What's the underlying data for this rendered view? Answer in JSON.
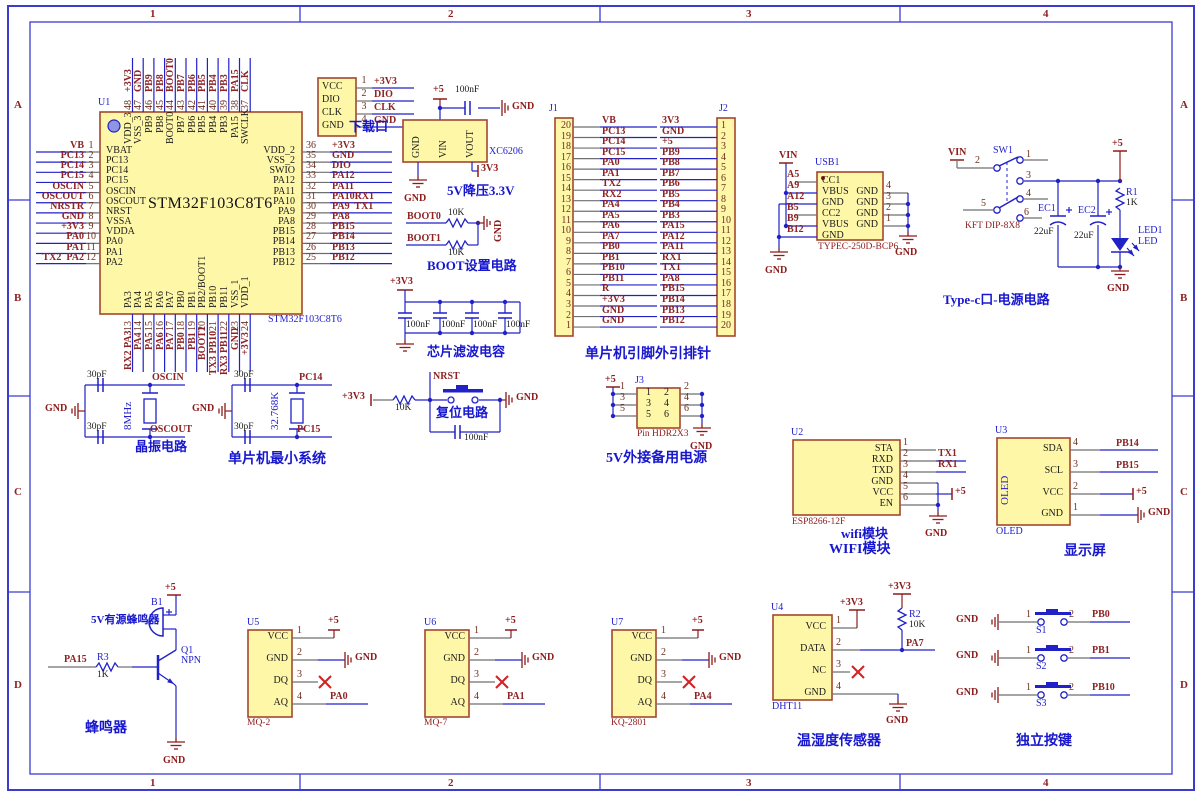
{
  "sheet": {
    "h_zones": [
      "1",
      "2",
      "3",
      "4"
    ],
    "v_zones": [
      "A",
      "B",
      "C",
      "D"
    ]
  },
  "colors": {
    "component_fill": "#fef7a8",
    "component_border": "#a3462e",
    "wire": "#2121c8",
    "power": "#8d1a1a",
    "net_text": "#8d2323",
    "designator": "#2020cc",
    "frame": "#3b3bd2"
  },
  "mcu": {
    "designator": "U1",
    "title": "STM32F103C8T6",
    "sub_label": "STM32F103C8T6",
    "left_pins": [
      {
        "net": "VB",
        "num": "1",
        "name": "VBAT"
      },
      {
        "net": "PC13",
        "num": "2",
        "name": "PC13"
      },
      {
        "net": "PC14",
        "num": "3",
        "name": "PC14"
      },
      {
        "net": "PC15",
        "num": "4",
        "name": "PC15"
      },
      {
        "net": "OSCIN",
        "num": "5",
        "name": "OSCIN"
      },
      {
        "net": "OSCOUT",
        "num": "6",
        "name": "OSCOUT"
      },
      {
        "net": "NRSTR",
        "num": "7",
        "name": "NRST"
      },
      {
        "net": "GND",
        "num": "8",
        "name": "VSSA"
      },
      {
        "net": "+3V3",
        "num": "9",
        "name": "VDDA"
      },
      {
        "net": "PA0",
        "num": "10",
        "name": "PA0"
      },
      {
        "net": "PA1",
        "num": "11",
        "name": "PA1"
      },
      {
        "net": "TX2  PA2",
        "num": "12",
        "name": "PA2"
      }
    ],
    "right_pins": [
      {
        "num": "36",
        "net": "+3V3",
        "name": "VDD_2"
      },
      {
        "num": "35",
        "net": "GND",
        "name": "VSS_2"
      },
      {
        "num": "34",
        "net": "DIO",
        "name": "SWIO"
      },
      {
        "num": "33",
        "net": "PA12",
        "name": "PA12"
      },
      {
        "num": "32",
        "net": "PA11",
        "name": "PA11"
      },
      {
        "num": "31",
        "net": "PA10RX1",
        "name": "PA10"
      },
      {
        "num": "30",
        "net": "PA9  TX1",
        "name": "PA9"
      },
      {
        "num": "29",
        "net": "PA8",
        "name": "PA8"
      },
      {
        "num": "28",
        "net": "PB15",
        "name": "PB15"
      },
      {
        "num": "27",
        "net": "PB14",
        "name": "PB14"
      },
      {
        "num": "26",
        "net": "PB13",
        "name": "PB13"
      },
      {
        "num": "25",
        "net": "PB12",
        "name": "PB12"
      }
    ],
    "top_pins": [
      {
        "num": "48",
        "net": "+3V3",
        "name": "VDD_3"
      },
      {
        "num": "47",
        "net": "GND",
        "name": "VSS_3"
      },
      {
        "num": "46",
        "net": "PB9",
        "name": "PB9"
      },
      {
        "num": "45",
        "net": "PB8",
        "name": "PB8"
      },
      {
        "num": "44",
        "net": "BOOT0",
        "name": "BOOT0"
      },
      {
        "num": "43",
        "net": "PB7",
        "name": "PB7"
      },
      {
        "num": "42",
        "net": "PB6",
        "name": "PB6"
      },
      {
        "num": "41",
        "net": "PB5",
        "name": "PB5"
      },
      {
        "num": "40",
        "net": "PB4",
        "name": "PB4"
      },
      {
        "num": "39",
        "net": "PB3",
        "name": "PB3"
      },
      {
        "num": "38",
        "net": "PA15",
        "name": "PA15"
      },
      {
        "num": "37",
        "net": "CLK",
        "name": "SWCLK"
      }
    ],
    "bottom_pins": [
      {
        "num": "13",
        "net": "RX2 PA3",
        "name": "PA3"
      },
      {
        "num": "14",
        "net": "PA4",
        "name": "PA4"
      },
      {
        "num": "15",
        "net": "PA5",
        "name": "PA5"
      },
      {
        "num": "16",
        "net": "PA6",
        "name": "PA6"
      },
      {
        "num": "17",
        "net": "PA7",
        "name": "PA7"
      },
      {
        "num": "18",
        "net": "PB0",
        "name": "PB0"
      },
      {
        "num": "19",
        "net": "PB1",
        "name": "PB1"
      },
      {
        "num": "20",
        "net": "BOOT1",
        "name": "PB2/BOOT1"
      },
      {
        "num": "21",
        "net": "TX3 PB10",
        "name": "PB10"
      },
      {
        "num": "22",
        "net": "RX3 PB11",
        "name": "PB11"
      },
      {
        "num": "23",
        "net": "GND",
        "name": "VSS_1"
      },
      {
        "num": "24",
        "net": "+3V3",
        "name": "VDD_1"
      }
    ]
  },
  "download": {
    "caption": "下载口",
    "rows": [
      {
        "name": "VCC",
        "num": "1",
        "net": "+3V3"
      },
      {
        "name": "DIO",
        "num": "2",
        "net": "DIO"
      },
      {
        "name": "CLK",
        "num": "3",
        "net": "CLK"
      },
      {
        "name": "GND",
        "num": "4",
        "net": "GND"
      }
    ]
  },
  "regulator": {
    "plus5": "+5",
    "cap_val": "100nF",
    "gnd_top": "GND",
    "pins": [
      "GND",
      "VIN",
      "VOUT"
    ],
    "part": "XC6206",
    "out_net": "3V3",
    "gnd_bottom": "GND",
    "caption": "5V降压3.3V"
  },
  "boot": {
    "rows": [
      {
        "net": "BOOT0",
        "val": "10K"
      },
      {
        "net": "BOOT1",
        "val": "10K"
      }
    ],
    "gnd": "GND",
    "caption": "BOOT设置电路"
  },
  "filter": {
    "rail": "+3V3",
    "caps": [
      "100nF",
      "100nF",
      "100nF",
      "100nF"
    ],
    "caption": "芯片滤波电容"
  },
  "j1": {
    "designator": "J1",
    "pins": [
      {
        "num": "20",
        "net": "VB"
      },
      {
        "num": "19",
        "net": "PC13"
      },
      {
        "num": "18",
        "net": "PC14"
      },
      {
        "num": "17",
        "net": "PC15"
      },
      {
        "num": "16",
        "net": "PA0"
      },
      {
        "num": "15",
        "net": "PA1"
      },
      {
        "num": "14",
        "net": "TX2"
      },
      {
        "num": "13",
        "net": "RX2"
      },
      {
        "num": "12",
        "net": "PA4"
      },
      {
        "num": "11",
        "net": "PA5"
      },
      {
        "num": "10",
        "net": "PA6"
      },
      {
        "num": "9",
        "net": "PA7"
      },
      {
        "num": "8",
        "net": "PB0"
      },
      {
        "num": "7",
        "net": "PB1"
      },
      {
        "num": "6",
        "net": "PB10"
      },
      {
        "num": "5",
        "net": "PB11"
      },
      {
        "num": "4",
        "net": "R"
      },
      {
        "num": "3",
        "net": "+3V3"
      },
      {
        "num": "2",
        "net": "GND"
      },
      {
        "num": "1",
        "net": "GND"
      }
    ]
  },
  "j2": {
    "designator": "J2",
    "pins": [
      {
        "num": "1",
        "net": "3V3"
      },
      {
        "num": "2",
        "net": "GND"
      },
      {
        "num": "3",
        "net": "+5"
      },
      {
        "num": "4",
        "net": "PB9"
      },
      {
        "num": "5",
        "net": "PB8"
      },
      {
        "num": "6",
        "net": "PB7"
      },
      {
        "num": "7",
        "net": "PB6"
      },
      {
        "num": "8",
        "net": "PB5"
      },
      {
        "num": "9",
        "net": "PB4"
      },
      {
        "num": "10",
        "net": "PB3"
      },
      {
        "num": "11",
        "net": "PA15"
      },
      {
        "num": "12",
        "net": "PA12"
      },
      {
        "num": "13",
        "net": "PA11"
      },
      {
        "num": "14",
        "net": "RX1"
      },
      {
        "num": "15",
        "net": "TX1"
      },
      {
        "num": "16",
        "net": "PA8"
      },
      {
        "num": "17",
        "net": "PB15"
      },
      {
        "num": "18",
        "net": "PB14"
      },
      {
        "num": "19",
        "net": "PB13"
      },
      {
        "num": "20",
        "net": "PB12"
      }
    ]
  },
  "headers_caption": "单片机引脚外引排针",
  "usb": {
    "designator": "USB1",
    "part": "TYPEC-250D-BCP6",
    "vin": "VIN",
    "gnd_left": "GND",
    "gnd_right": "GND",
    "left_pins": [
      {
        "pad": "A5",
        "name": "CC1"
      },
      {
        "pad": "A9",
        "name": "VBUS"
      },
      {
        "pad": "A12",
        "name": "GND"
      },
      {
        "pad": "B5",
        "name": "CC2"
      },
      {
        "pad": "B9",
        "name": "VBUS"
      },
      {
        "pad": "B12",
        "name": "GND"
      }
    ],
    "right_pins": [
      {
        "num": "4",
        "name": "GND"
      },
      {
        "num": "3",
        "name": "GND"
      },
      {
        "num": "2",
        "name": "GND"
      },
      {
        "num": "1",
        "name": "GND"
      }
    ]
  },
  "powersw": {
    "designator": "SW1",
    "part": "KFT DIP-8X8",
    "vin": "VIN",
    "plus5": "+5",
    "pin_nums": [
      "1",
      "2",
      "3",
      "4",
      "5",
      "6"
    ],
    "ec1": {
      "ref": "EC1",
      "val": "22uF"
    },
    "ec2": {
      "ref": "EC2",
      "val": "22uF"
    },
    "r1": {
      "ref": "R1",
      "val": "1K"
    },
    "led": {
      "ref": "LED1",
      "name": "LED"
    },
    "gnd": "GND",
    "caption": "Type-c口-电源电路"
  },
  "xtal1": {
    "cap_top": "30pF",
    "cap_bot": "30pF",
    "freq": "8MHz",
    "net_top": "OSCIN",
    "net_bot": "OSCOUT",
    "gnd": "GND",
    "caption": "晶振电路"
  },
  "xtal2": {
    "cap_top": "30pF",
    "cap_bot": "30pF",
    "freq": "32.768K",
    "net_top": "PC14",
    "net_bot": "PC15",
    "gnd": "GND",
    "caption": "单片机最小系统"
  },
  "reset": {
    "rail": "+3V3",
    "r_val": "10K",
    "net": "NRST",
    "cap_val": "100nF",
    "gnd": "GND",
    "caption": "复位电路"
  },
  "j3": {
    "designator": "J3",
    "plus5": "+5",
    "left_nums": [
      "1",
      "3",
      "5"
    ],
    "right_nums": [
      "2",
      "4",
      "6"
    ],
    "inner_left": [
      "1",
      "3",
      "5"
    ],
    "inner_right": [
      "2",
      "4",
      "6"
    ],
    "part": "Pin HDR2X3",
    "gnd": "GND",
    "caption": "5V外接备用电源"
  },
  "wifi": {
    "designator": "U2",
    "part": "ESP8266-12F",
    "gnd": "GND",
    "plus5": "+5",
    "pins": [
      {
        "name": "STA",
        "num": "1",
        "net": ""
      },
      {
        "name": "RXD",
        "num": "2",
        "net": "TX1"
      },
      {
        "name": "TXD",
        "num": "3",
        "net": "RX1"
      },
      {
        "name": "GND",
        "num": "4",
        "net": ""
      },
      {
        "name": "VCC",
        "num": "5",
        "net": "+5"
      },
      {
        "name": "EN",
        "num": "6",
        "net": ""
      }
    ],
    "caption1": "wifi模块",
    "caption2": "WIFI模块"
  },
  "oled": {
    "designator": "U3",
    "body": "OLED",
    "part": "OLED",
    "gnd": "GND",
    "plus5": "+5",
    "pins": [
      {
        "name": "SDA",
        "num": "4",
        "net": "PB14"
      },
      {
        "name": "SCL",
        "num": "3",
        "net": "PB15"
      },
      {
        "name": "VCC",
        "num": "2",
        "net": "+5"
      },
      {
        "name": "GND",
        "num": "1",
        "net": "GND"
      }
    ],
    "caption": "显示屏"
  },
  "buzzer": {
    "ref": "B1",
    "comment": "5V有源蜂鸣器",
    "plus5": "+5",
    "q_ref": "Q1",
    "q_type": "NPN",
    "r_ref": "R3",
    "r_val": "1K",
    "net": "PA15",
    "gnd": "GND",
    "caption": "蜂鸣器"
  },
  "sensors": [
    {
      "designator": "U5",
      "part": "MQ-2",
      "plus5": "+5",
      "gnd": "GND",
      "pins": [
        {
          "name": "VCC",
          "num": "1"
        },
        {
          "name": "GND",
          "num": "2"
        },
        {
          "name": "DQ",
          "num": "3"
        },
        {
          "name": "AQ",
          "num": "4",
          "net": "PA0"
        }
      ]
    },
    {
      "designator": "U6",
      "part": "MQ-7",
      "plus5": "+5",
      "gnd": "GND",
      "pins": [
        {
          "name": "VCC",
          "num": "1"
        },
        {
          "name": "GND",
          "num": "2"
        },
        {
          "name": "DQ",
          "num": "3"
        },
        {
          "name": "AQ",
          "num": "4",
          "net": "PA1"
        }
      ]
    },
    {
      "designator": "U7",
      "part": "KQ-2801",
      "plus5": "+5",
      "gnd": "GND",
      "pins": [
        {
          "name": "VCC",
          "num": "1"
        },
        {
          "name": "GND",
          "num": "2"
        },
        {
          "name": "DQ",
          "num": "3"
        },
        {
          "name": "AQ",
          "num": "4",
          "net": "PA4"
        }
      ]
    }
  ],
  "dht": {
    "designator": "U4",
    "part": "DHT11",
    "rail": "+3V3",
    "gnd": "GND",
    "pullup": {
      "ref": "R2",
      "val": "10K",
      "rail": "+3V3"
    },
    "pins": [
      {
        "name": "VCC",
        "num": "1"
      },
      {
        "name": "DATA",
        "num": "2",
        "net": "PA7"
      },
      {
        "name": "NC",
        "num": "3"
      },
      {
        "name": "GND",
        "num": "4"
      }
    ],
    "caption": "温湿度传感器"
  },
  "keys": {
    "rows": [
      {
        "gnd": "GND",
        "n1": "1",
        "ref": "S1",
        "n2": "2",
        "net": "PB0"
      },
      {
        "gnd": "GND",
        "n1": "1",
        "ref": "S2",
        "n2": "2",
        "net": "PB1"
      },
      {
        "gnd": "GND",
        "n1": "1",
        "ref": "S3",
        "n2": "2",
        "net": "PB10"
      }
    ],
    "caption": "独立按键"
  }
}
